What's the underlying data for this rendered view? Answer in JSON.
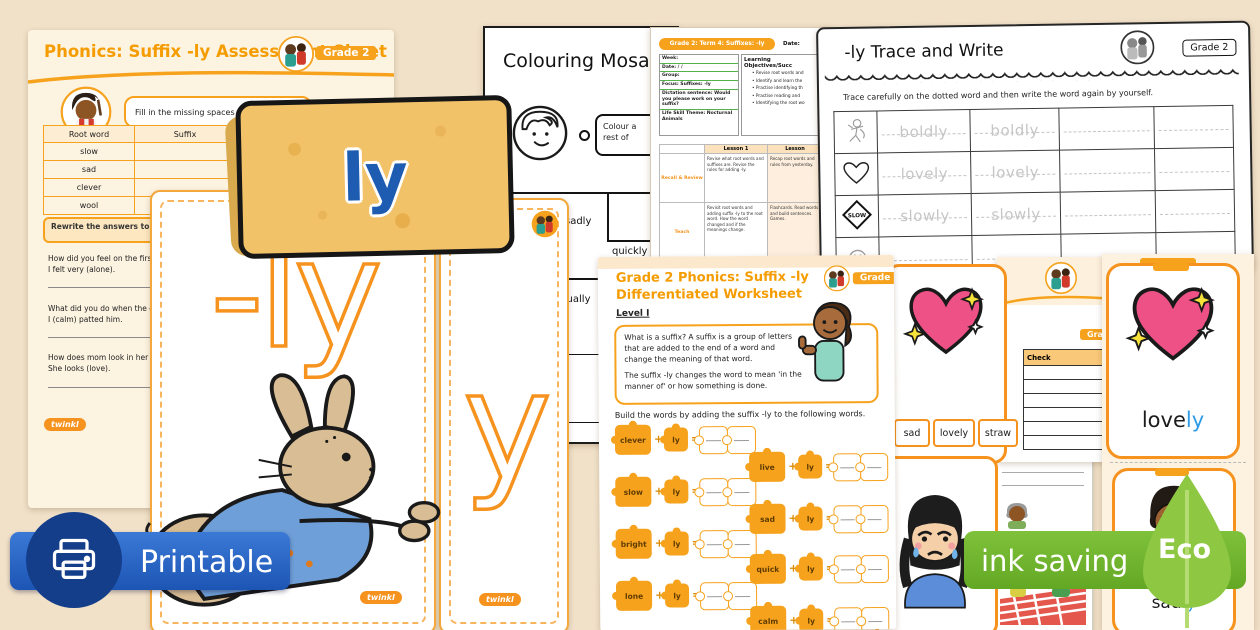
{
  "brand": {
    "name": "twinkl"
  },
  "tag": {
    "label": "ly"
  },
  "flashcards": {
    "big_text": "-ly",
    "partial_text": "y"
  },
  "printable_badge": {
    "label": "Printable"
  },
  "eco_badge": {
    "ink_saving": "ink saving",
    "eco": "Eco"
  },
  "assessment_sheet": {
    "title": "Phonics: Suffix -ly Assessment Sheet",
    "grade": "Grade 2",
    "instruction": "Fill in the missing spaces in the table.",
    "table": {
      "headers": [
        "Root word",
        "Suffix"
      ],
      "rows": [
        "slow",
        "sad",
        "clever",
        "wool"
      ]
    },
    "rewrite_note": "Rewrite the answers to the qu the brackets.",
    "questions": [
      {
        "q": "How did you feel on the first d",
        "a": "I felt very (alone)."
      },
      {
        "q": "What did you do when the dog",
        "a": "I (calm) patted him."
      },
      {
        "q": "How does mom look in her nev",
        "a": "She looks (love)."
      }
    ]
  },
  "mosaic_sheet": {
    "title": "Colouring Mosaic",
    "bubble_line1": "Colour a",
    "bubble_line2": "rest of",
    "words": [
      "sadly",
      "quickly",
      "actually"
    ]
  },
  "lesson_plan": {
    "header": "Grade 2: Term 4: Suffixes: -ly",
    "date_label": "Date:",
    "fields": [
      "Week:",
      "Date:  /  /",
      "Group:",
      "Focus: Suffixes: -ly",
      "Dictation sentence: Would you please work on your suffix?",
      "Life Skill Theme: Nocturnal Animals"
    ],
    "objectives_header": "Learning Objectives/Succ",
    "objectives": [
      "Revise root words and",
      "Identify and learn the",
      "Practise identifying th",
      "Practise reading and",
      "Identifying the root wo"
    ],
    "lesson1": "Lesson 1",
    "lesson2": "Lesson",
    "row1_label": "Recall & Review",
    "row2_label": "Teach",
    "r1c1": "Revise what root words and suffixes are. Revise the rules for adding -ly.",
    "r1c2": "Recap root words and rules from yesterday.",
    "r2c1": "Revisit root words and adding suffix -ly to the root word. How the word changed and if the meanings change.",
    "r2c2": "Flashcards. Read words and build sentences. Games."
  },
  "trace_sheet": {
    "title": "-ly Trace and Write",
    "grade": "Grade 2",
    "instruction": "Trace carefully on the dotted word and then write the word again by yourself.",
    "rows": [
      {
        "word": "boldly"
      },
      {
        "word": "lovely"
      },
      {
        "word": "slowly"
      }
    ],
    "slow_sign": "SLOW"
  },
  "worksheet": {
    "title_line1": "Grade 2 Phonics: Suffix -ly",
    "title_line2": "Differentiated Worksheet",
    "grade": "Grade 2",
    "level": "Level I",
    "para1": "What is a suffix? A suffix is a group of letters that are added to the end of a word and change the meaning of that word.",
    "para2": "The suffix -ly changes the word to mean 'in the manner of' or how something is done.",
    "build": "Build the words by adding the suffix -ly to the following words.",
    "suffix": "ly",
    "plus": "+",
    "equals": "=",
    "left_words": [
      "clever",
      "slow",
      "bright",
      "lone"
    ],
    "right_words": [
      "live",
      "sad",
      "quick",
      "calm"
    ]
  },
  "word_card": {
    "options": [
      "sad",
      "lovely",
      "straw"
    ]
  },
  "check_sheet": {
    "header": "Check",
    "grade": "Grade 2"
  },
  "lovely_card": {
    "root": "love",
    "suffix": "ly"
  },
  "sadly_card": {
    "root": "sad",
    "suffix": "ly"
  }
}
